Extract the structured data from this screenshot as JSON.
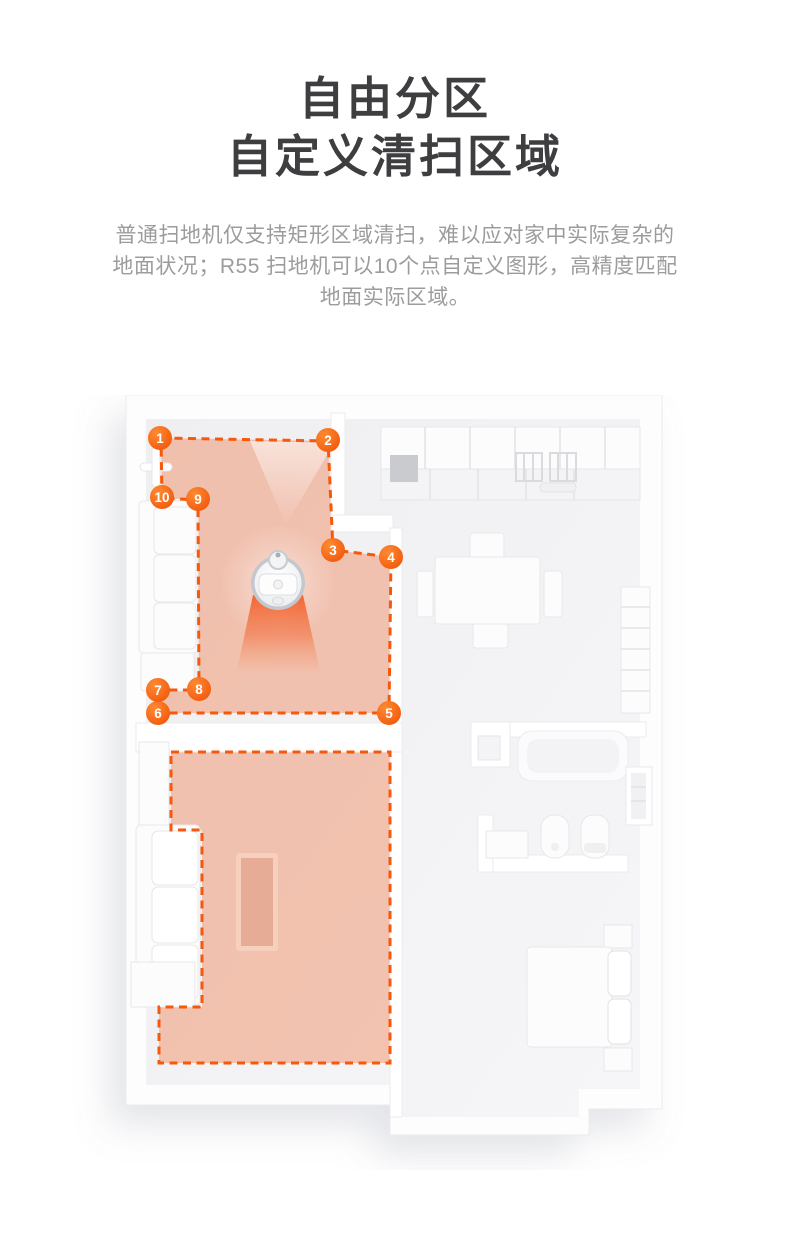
{
  "header": {
    "title_lines": [
      "自由分区",
      "自定义清扫区域"
    ],
    "description_lines": [
      "普通扫地机仅支持矩形区域清扫，难以应对家中实际复杂的",
      "地面状况；R55 扫地机可以10个点自定义图形，高精度匹配",
      "地面实际区域。"
    ]
  },
  "colors": {
    "accent_orange": "#f6590b",
    "marker_orange_dark": "#ee4f04",
    "marker_orange_light": "#ff8a33",
    "zone_fill": "#f17e4f",
    "title_text": "#3e3e41",
    "body_text": "#9c9c9c"
  },
  "floor_plan": {
    "zone_point_markers": [
      {
        "label": "1"
      },
      {
        "label": "2"
      },
      {
        "label": "3"
      },
      {
        "label": "4"
      },
      {
        "label": "5"
      },
      {
        "label": "6"
      },
      {
        "label": "7"
      },
      {
        "label": "8"
      },
      {
        "label": "9"
      },
      {
        "label": "10"
      }
    ]
  }
}
